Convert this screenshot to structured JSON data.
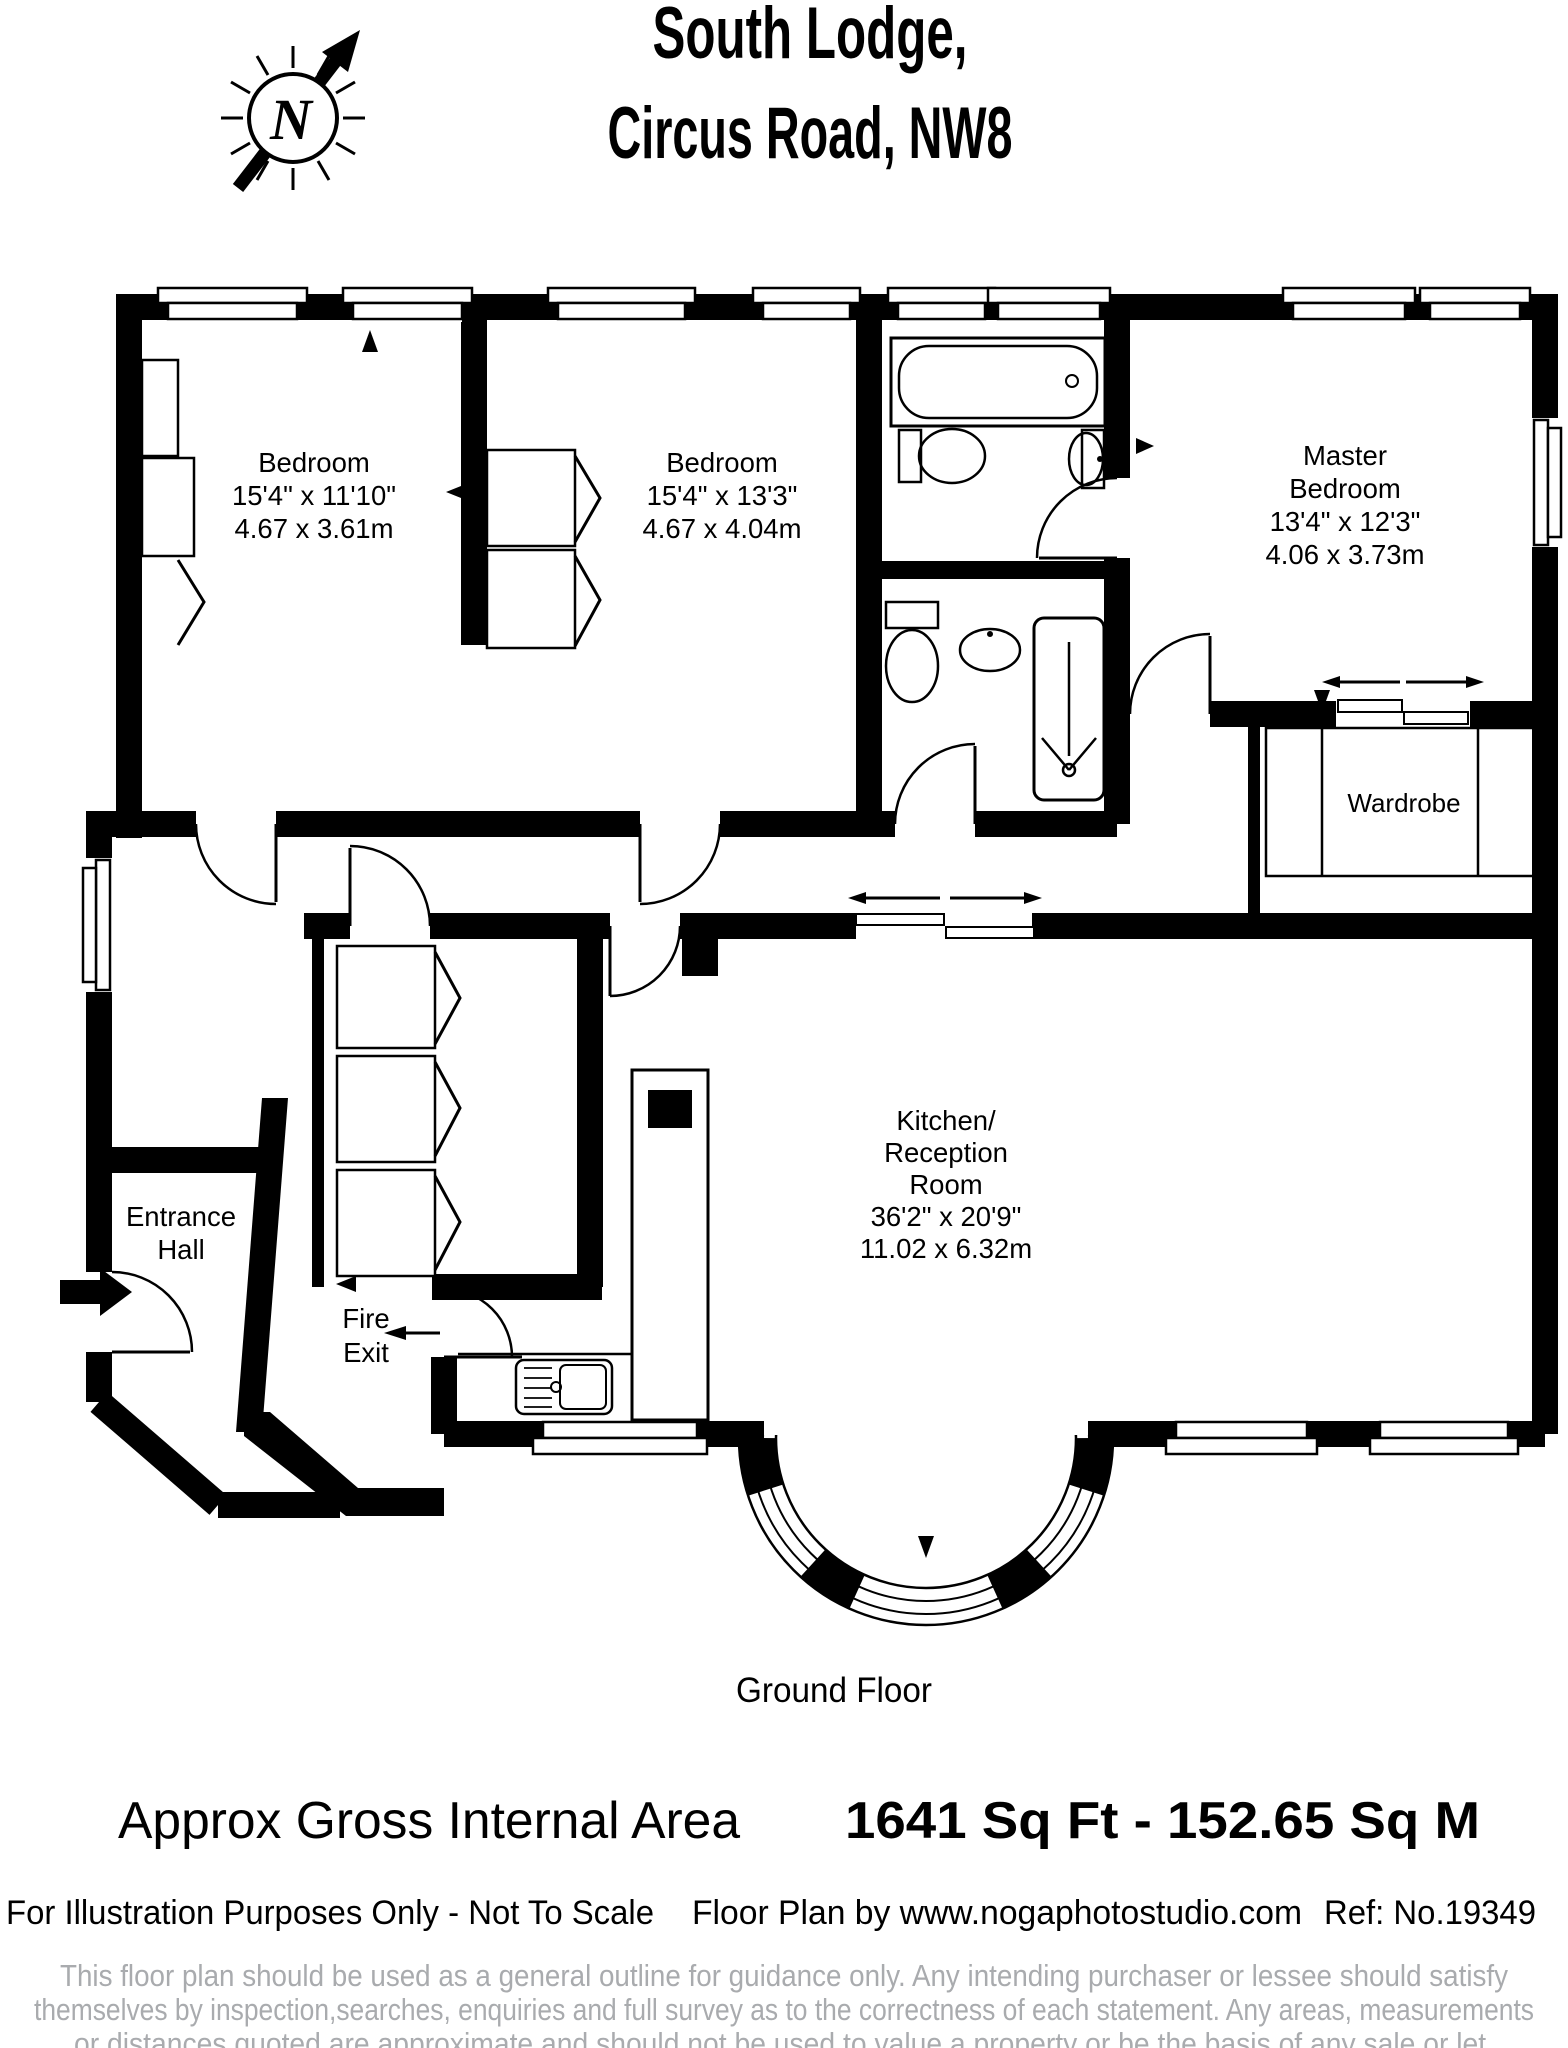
{
  "title": {
    "line1": "South Lodge,",
    "line2": "Circus Road, NW8"
  },
  "compass": {
    "label": "N"
  },
  "rooms": {
    "bedroom1": {
      "name": "Bedroom",
      "imperial": "15'4\" x 11'10\"",
      "metric": "4.67 x 3.61m"
    },
    "bedroom2": {
      "name": "Bedroom",
      "imperial": "15'4\" x 13'3\"",
      "metric": "4.67 x 4.04m"
    },
    "master": {
      "name_line1": "Master",
      "name_line2": "Bedroom",
      "imperial": "13'4\" x 12'3\"",
      "metric": "4.06 x 3.73m"
    },
    "wardrobe": {
      "name": "Wardrobe"
    },
    "kitchen": {
      "name_line1": "Kitchen/",
      "name_line2": "Reception",
      "name_line3": "Room",
      "imperial": "36'2\" x 20'9\"",
      "metric": "11.02 x 6.32m"
    },
    "entrance_hall": {
      "name_line1": "Entrance",
      "name_line2": "Hall"
    },
    "fire_exit": {
      "name_line1": "Fire",
      "name_line2": "Exit"
    }
  },
  "floor_label": "Ground Floor",
  "area_summary": {
    "label": "Approx Gross Internal Area",
    "value": "1641 Sq Ft  -  152.65 Sq M"
  },
  "footer": {
    "note": "For Illustration Purposes Only - Not To Scale",
    "credit": "Floor Plan by www.nogaphotostudio.com",
    "reference": "Ref: No.19349"
  },
  "disclaimer": [
    "This floor plan should be used as a general outline for guidance only. Any intending purchaser or lessee should satisfy",
    "themselves by inspection,searches, enquiries and full survey as to the correctness of each statement. Any areas, measurements",
    "or distances quoted are approximate and should not be used to value a property or be the basis of any sale or let."
  ],
  "colors": {
    "wall": "#000000",
    "background": "#ffffff",
    "disclaimer_text": "#a9abae"
  }
}
